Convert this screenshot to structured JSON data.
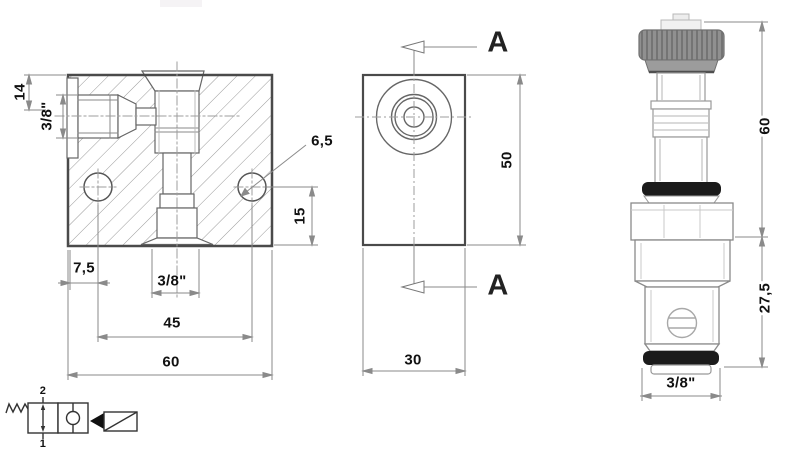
{
  "front_view": {
    "dim_top_height": "14",
    "dim_side_port": "3/8\"",
    "dim_edge_offset": "7,5",
    "dim_bottom_port": "3/8\"",
    "dim_hole_spacing": "45",
    "dim_block_width": "60",
    "dim_hole_diameter": "6,5",
    "dim_hole_height": "15"
  },
  "side_view": {
    "dim_height": "50",
    "dim_depth": "30",
    "section_label_top": "A",
    "section_label_bottom": "A"
  },
  "cartridge_view": {
    "dim_upper_length": "60",
    "dim_cartridge_length": "27,5",
    "dim_thread": "3/8\""
  },
  "schematic": {
    "port_top_label": "2",
    "port_bottom_label": "1"
  },
  "colors": {
    "oring": "#1b1b1b",
    "knurl": "#909090",
    "line": "#4a4a4a"
  }
}
